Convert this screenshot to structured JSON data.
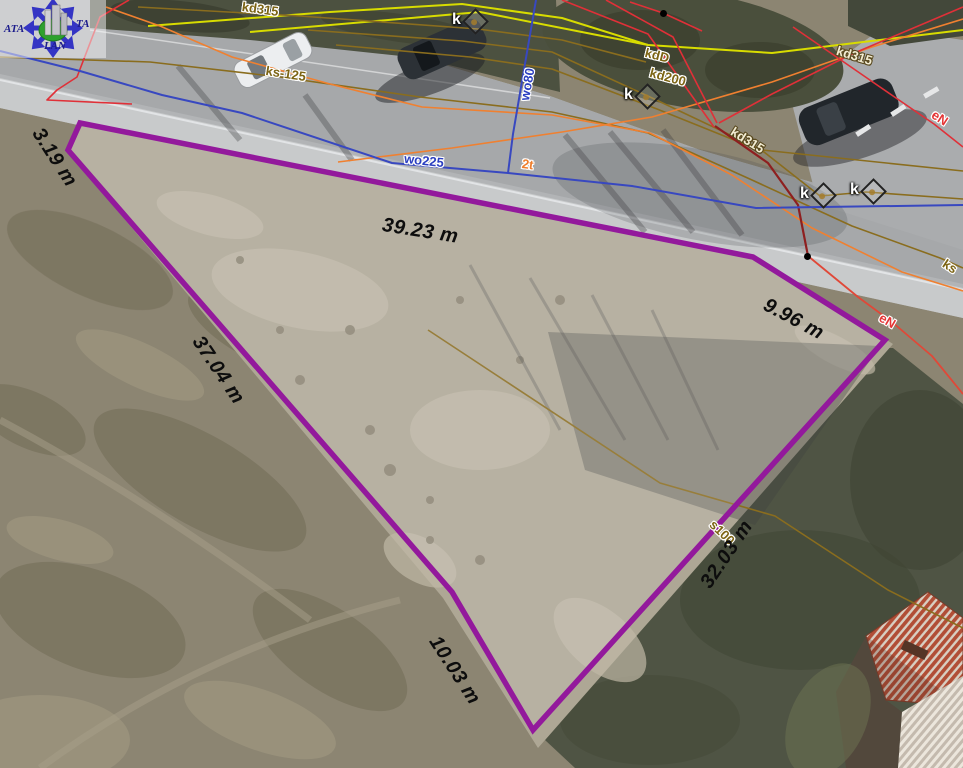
{
  "logo": {
    "text_left": "ATA",
    "text_right": "TA",
    "text_bottom": "LAN"
  },
  "parcel": {
    "outline_color": "#93199c",
    "measurements": [
      {
        "text": "3.19 m"
      },
      {
        "text": "39.23 m"
      },
      {
        "text": "9.96 m"
      },
      {
        "text": "37.04 m"
      },
      {
        "text": "32.03 m"
      },
      {
        "text": "10.03 m"
      }
    ]
  },
  "utilities": {
    "labels": [
      {
        "text": "kd315",
        "color": "#7c6414"
      },
      {
        "text": "ks-125",
        "color": "#7c6414"
      },
      {
        "text": "wo80",
        "color": "#2b3fc0"
      },
      {
        "text": "wo225",
        "color": "#2b3fc0"
      },
      {
        "text": "2t",
        "color": "#ef7f2e"
      },
      {
        "text": "kdD",
        "color": "#7c6414"
      },
      {
        "text": "kd200",
        "color": "#7c6414"
      },
      {
        "text": "kd315",
        "color": "#f2ecd2"
      },
      {
        "text": "kd315",
        "color": "#f2ecd2"
      },
      {
        "text": "eN",
        "color": "#e53535"
      },
      {
        "text": "eN",
        "color": "#e53535"
      },
      {
        "text": "ks",
        "color": "#7c6414"
      },
      {
        "text": "s100",
        "color": "#7c6414"
      }
    ],
    "symbol_k": "k"
  },
  "colors": {
    "parcel_outline": "#93199c",
    "water_line_blue": "#3848c0",
    "sewer_line_olive": "#8a6d1e",
    "storm_line_orange": "#f08030",
    "power_line_red": "#e03038",
    "gas_line_yellow": "#d8dc00"
  }
}
